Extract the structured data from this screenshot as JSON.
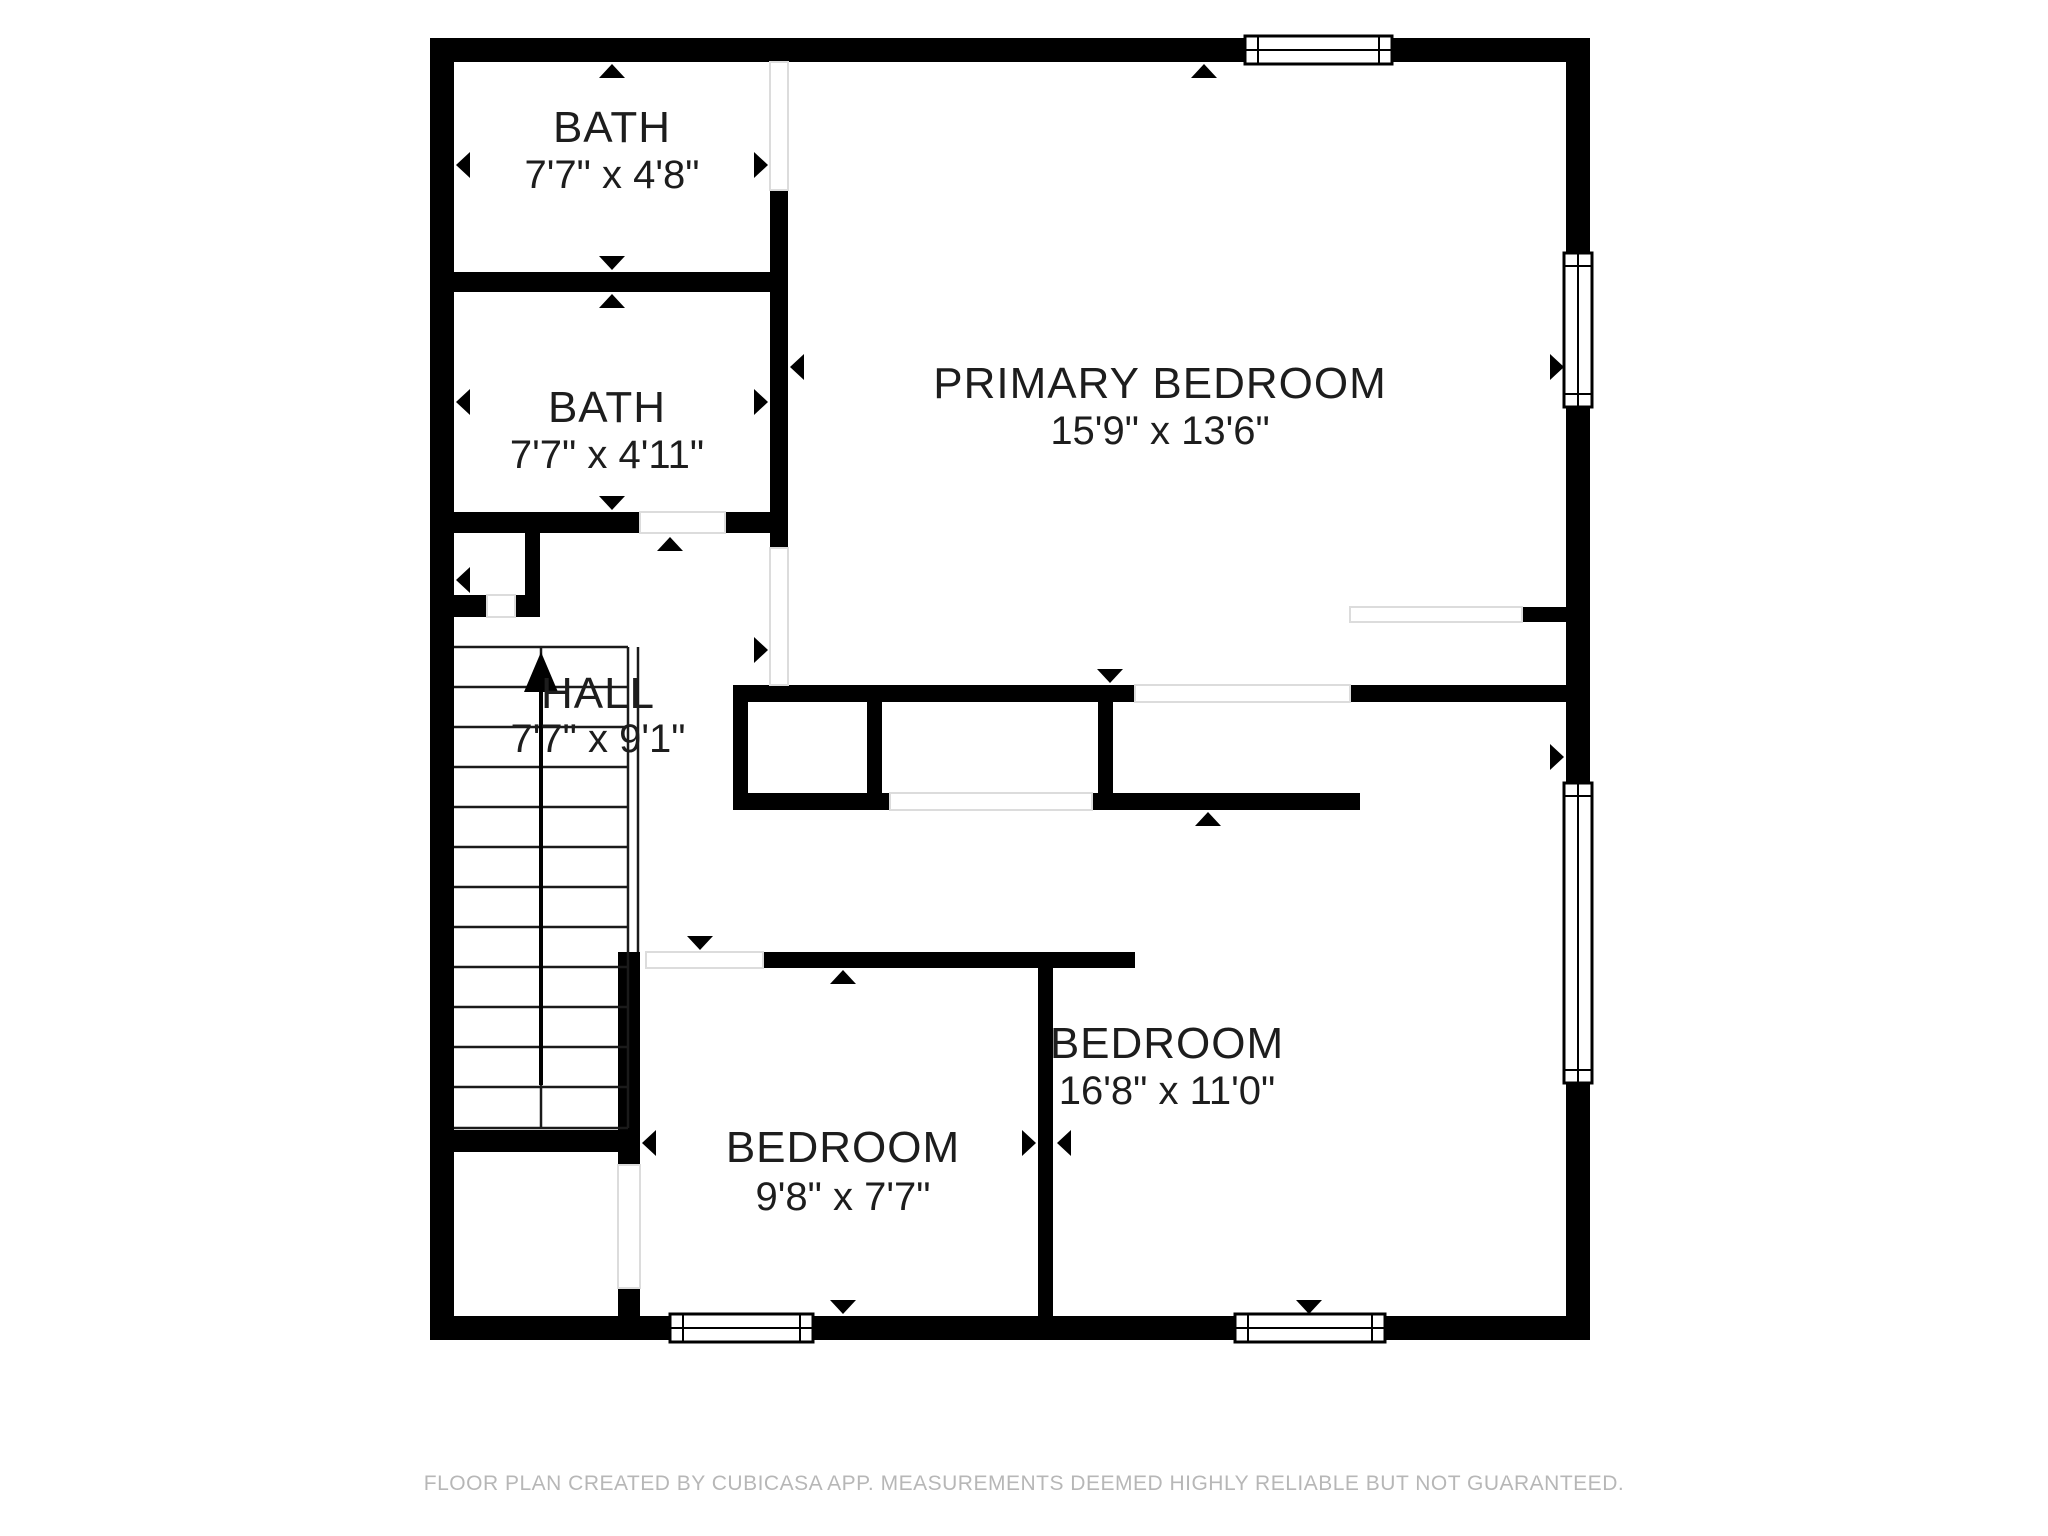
{
  "meta": {
    "app": "CubiCasa floor plan",
    "floor_type": "upper floor",
    "colors": {
      "wall": "#000000",
      "background": "#ffffff",
      "label_text": "#1d1d1d",
      "footer_text": "#b7b7b7",
      "opening_line": "#dcdcdc"
    }
  },
  "rooms": [
    {
      "id": "bath-top",
      "name": "BATH",
      "dimensions": "7'7\" x 4'8\""
    },
    {
      "id": "bath-middle",
      "name": "BATH",
      "dimensions": "7'7\" x 4'11\""
    },
    {
      "id": "primary-bedroom",
      "name": "PRIMARY BEDROOM",
      "dimensions": "15'9\" x 13'6\""
    },
    {
      "id": "hall",
      "name": "HALL",
      "dimensions": "7'7\" x 9'1\""
    },
    {
      "id": "bedroom-small",
      "name": "BEDROOM",
      "dimensions": "9'8\" x 7'7\""
    },
    {
      "id": "bedroom-large",
      "name": "BEDROOM",
      "dimensions": "16'8\" x 11'0\""
    }
  ],
  "features": {
    "stairs": {
      "direction": "up",
      "treads": 12
    },
    "windows": [
      "top-wall-primary-bedroom",
      "right-wall-primary-bedroom",
      "right-wall-bedroom-large",
      "bottom-wall-bedroom-small",
      "bottom-wall-bedroom-large"
    ],
    "doors": [
      "bath-top-to-primary-bedroom",
      "bath-middle-to-hall",
      "hall-to-primary-bedroom",
      "hall-closet",
      "primary-bedroom-to-bedroom-large",
      "closet-front",
      "hall-to-bedroom-area",
      "under-stair-storage"
    ]
  },
  "footer": {
    "disclaimer": "FLOOR PLAN CREATED BY CUBICASA APP. MEASUREMENTS DEEMED HIGHLY RELIABLE BUT NOT GUARANTEED."
  }
}
